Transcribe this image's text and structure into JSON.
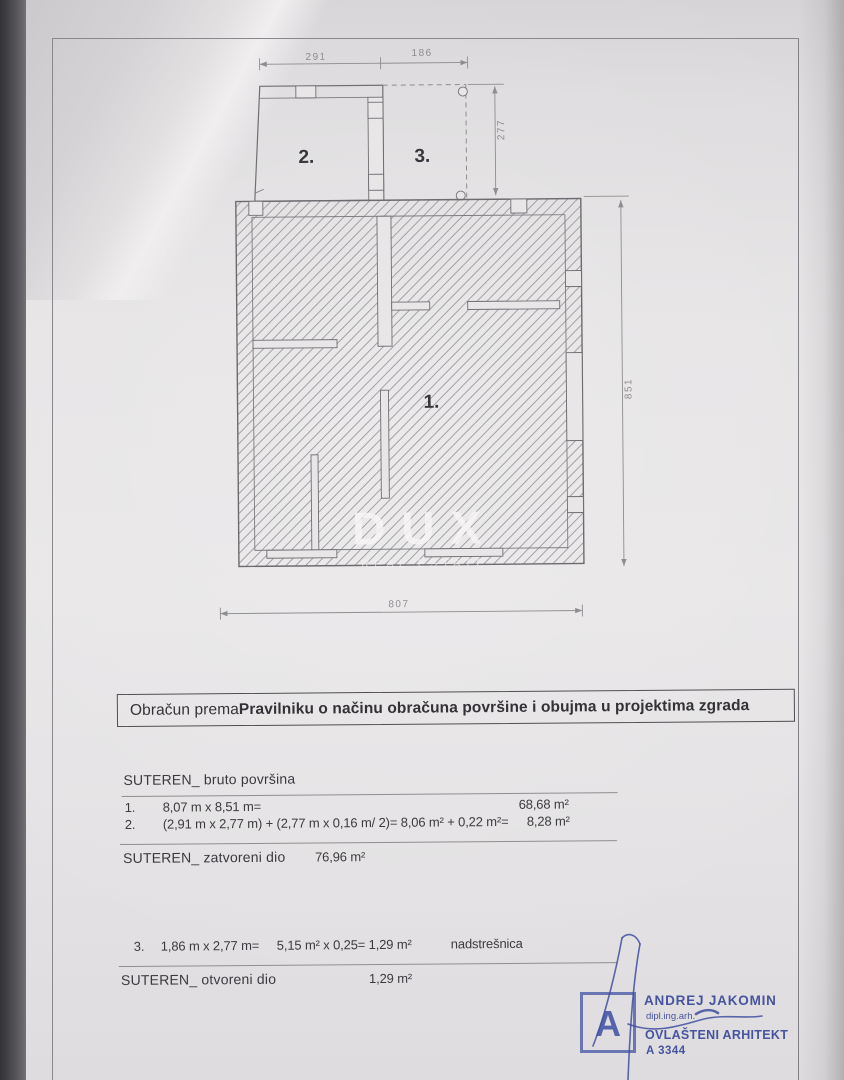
{
  "document": {
    "watermark": {
      "brand": "DUX",
      "tagline": "REAL ESTATE"
    },
    "plan": {
      "room_labels": {
        "main": "1.",
        "annex": "2.",
        "canopy": "3."
      },
      "dimensions": {
        "annex_width": "291",
        "canopy_width": "186",
        "annex_depth": "277",
        "main_height": "851",
        "main_width": "807"
      }
    },
    "statement": {
      "prefix": "Obračun prema ",
      "regulation": "Pravilniku o načinu obračuna površine i obujma u projektima zgrada"
    },
    "gross": {
      "title": "SUTEREN_ bruto površina",
      "rows": [
        {
          "no": "1.",
          "formula": "8,07 m x 8,51 m=",
          "result": "68,68 m²"
        },
        {
          "no": "2.",
          "formula": "(2,91 m x 2,77 m) + (2,77 m x 0,16 m/ 2)= 8,06 m² + 0,22 m²=",
          "result": "8,28 m²"
        }
      ]
    },
    "closed": {
      "label": "SUTEREN_ zatvoreni dio",
      "value": "76,96 m²"
    },
    "open_calc": {
      "no": "3.",
      "formula": "1,86 m x 2,77 m=",
      "calc": "5,15 m² x 0,25= 1,29 m²",
      "note": "nadstrešnica"
    },
    "open": {
      "label": "SUTEREN_ otvoreni dio",
      "value": "1,29 m²"
    },
    "architect": {
      "name": "ANDREJ JAKOMIN",
      "degree": "dipl.ing.arh.",
      "title": "OVLAŠTENI ARHITEKT",
      "license": "A 3344",
      "stamp_letter": "A"
    }
  },
  "colors": {
    "stamp_blue": "#4857a8",
    "paper": "#e7e5e6",
    "ink": "#3b3940",
    "drawing_line": "#716f75"
  }
}
